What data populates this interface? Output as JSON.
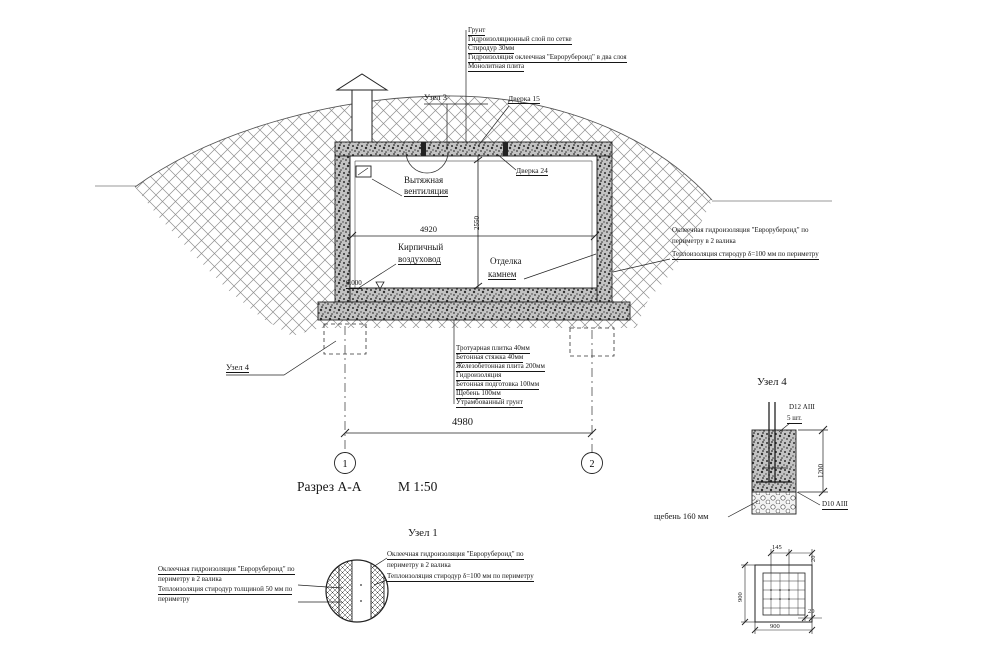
{
  "drawing": {
    "section_title": "Разрез А-А",
    "section_scale": "М 1:50",
    "axis_left": "1",
    "axis_right": "2",
    "dim_overall": "4980",
    "dim_interior_width": "4920",
    "dim_interior_height": "2550",
    "level_mark": "0.000"
  },
  "roof_layers": [
    "Грунт",
    "Гидроизоляционный слой по сетке",
    "Стиродур 30мм",
    "Гидроизоляция оклеечная \"Еврорубероид\" в два слоя",
    "Монолитная плита"
  ],
  "floor_layers": [
    "Тротуарная плитка 40мм",
    "Бетонная стяжка 40мм",
    "Железобетонная плита 200мм",
    "Гидроизоляция",
    "Бетонная подготовка 100мм",
    "Щебень 100мм",
    "Утрамбованный грунт"
  ],
  "callouts": {
    "node3": "Узел 3",
    "door_top": "Дверка 15",
    "door_inner": "Дверка 24",
    "exhaust_line1": "Вытяжная",
    "exhaust_line2": "вентиляция",
    "duct_line1": "Кирпичный",
    "duct_line2": "воздуховод",
    "finish_line1": "Отделка",
    "finish_line2": "камнем",
    "node4_ref": "Узел 4",
    "wall_line1": "Оклеечная гидроизоляция \"Еврорубероид\" по",
    "wall_line2": "периметру в 2 валика",
    "wall_line3": "Теплоизоляция стиродур δ=100 мм по периметру"
  },
  "node1": {
    "title": "Узел 1",
    "left_line1": "Оклеечная гидроизоляция \"Еврорубероид\" по",
    "left_line2": "периметру в 2 валика",
    "left_line3": "Теплоизоляция стиродур толщиной 50 мм по",
    "left_line4": "периметру",
    "right_line1": "Оклеечная гидроизоляция \"Еврорубероид\" по",
    "right_line2": "периметру в 2 валика",
    "right_line3": "Теплоизоляция стиродур δ=100 мм по периметру"
  },
  "node4": {
    "title": "Узел 4",
    "rebar_top": "D12 АIII",
    "rebar_count": "5 шт.",
    "dim_height": "1200",
    "rebar_bottom": "D10 АIII",
    "gravel_note": "щебень 160 мм",
    "plan_dim_top": "145",
    "plan_offset_top": "20",
    "plan_dim_left": "900",
    "plan_dim_bottom": "900",
    "plan_offset_bottom": "20"
  }
}
